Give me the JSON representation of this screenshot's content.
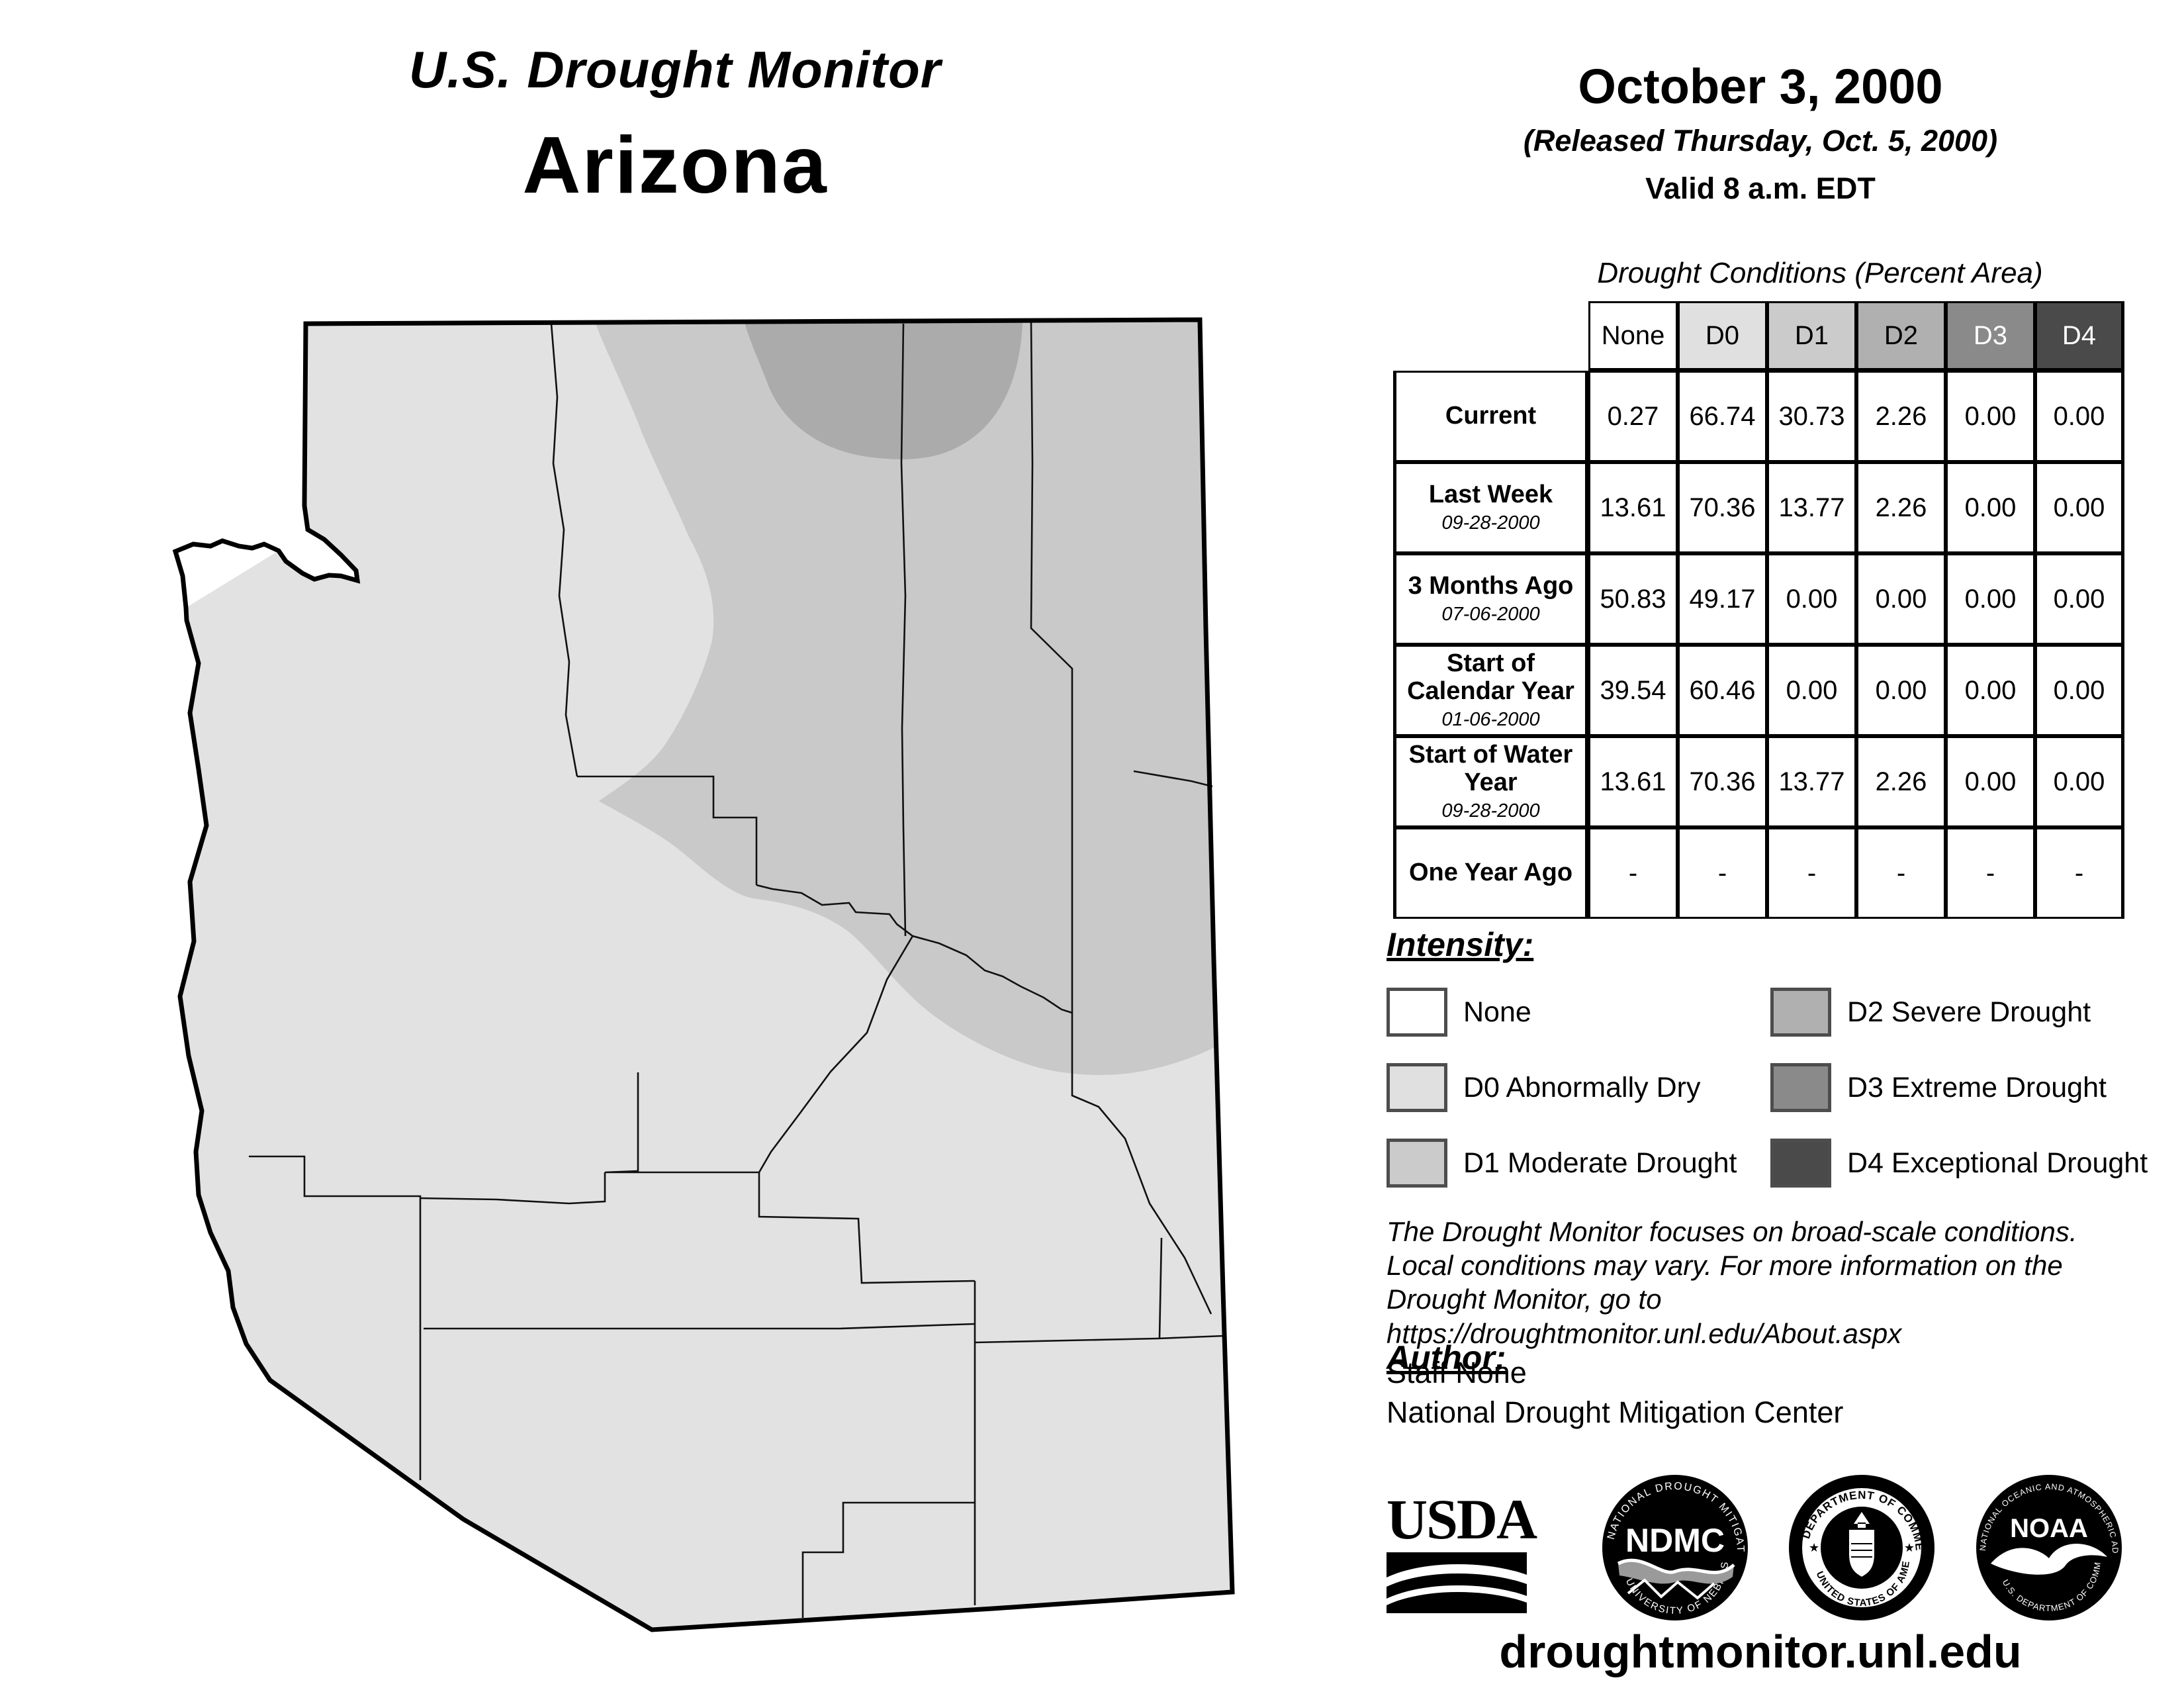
{
  "header": {
    "title": "U.S. Drought Monitor",
    "region": "Arizona"
  },
  "date_block": {
    "date": "October 3, 2000",
    "released": "(Released Thursday, Oct. 5, 2000)",
    "valid": "Valid 8 a.m. EDT"
  },
  "table": {
    "title": "Drought Conditions (Percent Area)",
    "columns": [
      "None",
      "D0",
      "D1",
      "D2",
      "D3",
      "D4"
    ],
    "header_colors": {
      "none": "#ffffff",
      "d0": "#e0e0e0",
      "d1": "#cbcbcb",
      "d2": "#b0b0b0",
      "d3": "#8a8a8a",
      "d4": "#4a4a4a"
    },
    "rows": [
      {
        "label": "Current",
        "date": "",
        "values": [
          "0.27",
          "66.74",
          "30.73",
          "2.26",
          "0.00",
          "0.00"
        ]
      },
      {
        "label": "Last Week",
        "date": "09-28-2000",
        "values": [
          "13.61",
          "70.36",
          "13.77",
          "2.26",
          "0.00",
          "0.00"
        ]
      },
      {
        "label": "3 Months Ago",
        "date": "07-06-2000",
        "values": [
          "50.83",
          "49.17",
          "0.00",
          "0.00",
          "0.00",
          "0.00"
        ]
      },
      {
        "label": "Start of Calendar Year",
        "date": "01-06-2000",
        "values": [
          "39.54",
          "60.46",
          "0.00",
          "0.00",
          "0.00",
          "0.00"
        ]
      },
      {
        "label": "Start of Water Year",
        "date": "09-28-2000",
        "values": [
          "13.61",
          "70.36",
          "13.77",
          "2.26",
          "0.00",
          "0.00"
        ]
      },
      {
        "label": "One Year Ago",
        "date": "",
        "values": [
          "-",
          "-",
          "-",
          "-",
          "-",
          "-"
        ]
      }
    ]
  },
  "legend": {
    "title": "Intensity:",
    "items": [
      {
        "label": "None",
        "color": "#ffffff"
      },
      {
        "label": "D0 Abnormally Dry",
        "color": "#e0e0e0"
      },
      {
        "label": "D1 Moderate Drought",
        "color": "#cbcbcb"
      },
      {
        "label": "D2 Severe Drought",
        "color": "#b0b0b0"
      },
      {
        "label": "D3 Extreme Drought",
        "color": "#8a8a8a"
      },
      {
        "label": "D4 Exceptional Drought",
        "color": "#4a4a4a"
      }
    ]
  },
  "disclaimer": {
    "line1": "The Drought Monitor focuses on broad-scale conditions.",
    "line2": "Local conditions may vary. For more information on the",
    "line3": "Drought Monitor, go to https://droughtmonitor.unl.edu/About.aspx"
  },
  "author": {
    "title": "Author:",
    "name": "Staff None",
    "org": "National Drought Mitigation Center"
  },
  "logos": {
    "usda": {
      "word": "USDA"
    },
    "ndmc": {
      "center": "NDMC",
      "ring_top": "NATIONAL DROUGHT MITIGATION CENTER",
      "ring_bottom": "UNIVERSITY OF NEBRASKA"
    },
    "doc": {
      "ring_top": "DEPARTMENT OF COMMERCE",
      "ring_bottom": "UNITED STATES OF AMERICA"
    },
    "noaa": {
      "center": "NOAA",
      "ring_top": "NATIONAL OCEANIC AND ATMOSPHERIC ADMINISTRATION",
      "ring_bottom": "U.S. DEPARTMENT OF COMMERCE"
    }
  },
  "footer": {
    "url": "droughtmonitor.unl.edu"
  },
  "map": {
    "colors": {
      "none": "#ffffff",
      "d0": "#e2e2e2",
      "d1": "#c9c9c9",
      "d2": "#ababab"
    }
  }
}
